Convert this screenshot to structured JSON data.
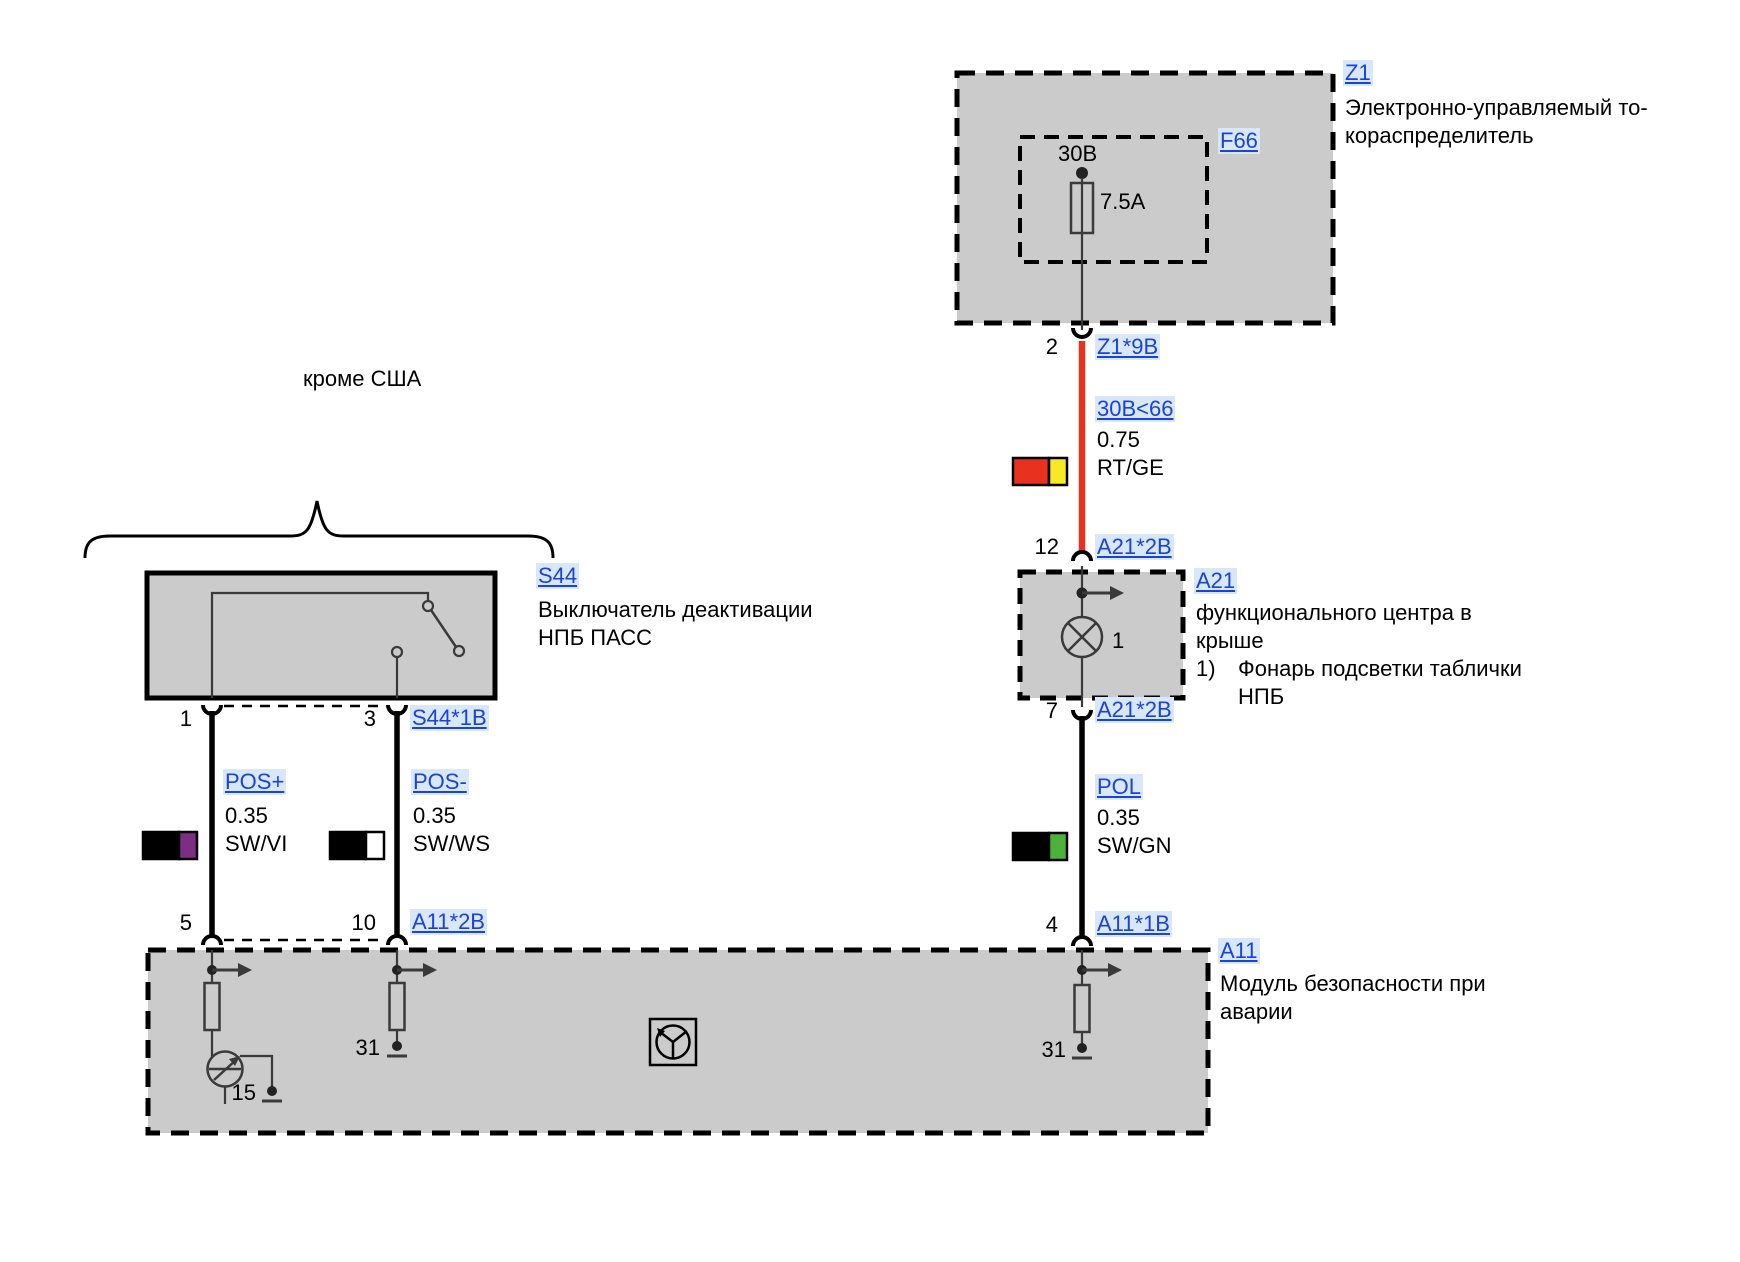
{
  "colors": {
    "box_fill": "#cbcbcb",
    "wire_red": "#e8321f",
    "code_yellow": "#f6e925",
    "code_violet": "#7b2e83",
    "code_green": "#4cb23c",
    "code_white": "#ffffff",
    "code_black": "#000000",
    "link_blue": "#1b43d6"
  },
  "region_note": {
    "label": "кроме США"
  },
  "z1": {
    "code": "Z1",
    "desc1": "Электронно-управляемый то-",
    "desc2": "кораспределитель",
    "fuse": {
      "code": "F66",
      "terminal": "30B",
      "rating": "7.5A"
    },
    "pin": "2",
    "connector": "Z1*9B"
  },
  "wire_30b": {
    "name": "30B<66",
    "gauge": "0.75",
    "color": "RT/GE"
  },
  "a21": {
    "code": "A21",
    "desc1": "функционального центра в",
    "desc2": "крыше",
    "fn_index": "1)",
    "fn_line1": "Фонарь подсветки таблички",
    "fn_line2": "НПБ",
    "pin_top": "12",
    "conn_top": "A21*2B",
    "pin_bottom": "7",
    "conn_bottom": "A21*2B",
    "lamp_ref": "1"
  },
  "wire_pol": {
    "name": "POL",
    "gauge": "0.35",
    "color": "SW/GN"
  },
  "s44": {
    "code": "S44",
    "desc1": "Выключатель деактивации",
    "desc2": "НПБ ПАСС",
    "pin_left": "1",
    "pin_right": "3",
    "conn": "S44*1B"
  },
  "wire_pos_plus": {
    "name": "POS+",
    "gauge": "0.35",
    "color": "SW/VI"
  },
  "wire_pos_minus": {
    "name": "POS-",
    "gauge": "0.35",
    "color": "SW/WS"
  },
  "a11": {
    "code": "A11",
    "desc1": "Модуль безопасности при",
    "desc2": "аварии",
    "pin_left": "5",
    "pin_mid": "10",
    "pin_right": "4",
    "conn_left": "A11*2B",
    "conn_right": "A11*1B",
    "terminal_15": "15",
    "terminal_31_mid": "31",
    "terminal_31_right": "31"
  }
}
